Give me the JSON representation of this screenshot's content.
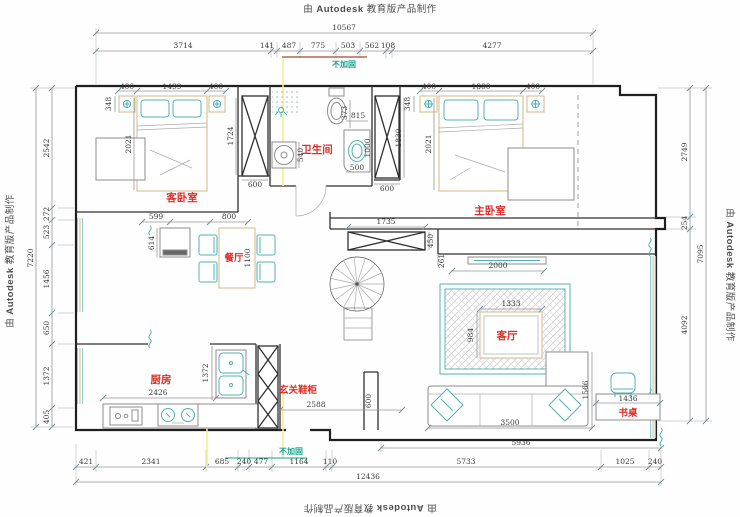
{
  "watermark": {
    "prefix": "由 ",
    "brand": "Autodesk",
    "suffix": " 教育版产品制作"
  },
  "notes": {
    "top": "不加固",
    "bottom": "不加固"
  },
  "rooms": {
    "guest_bedroom": "客卧室",
    "bathroom": "卫生间",
    "master_bedroom": "主卧室",
    "dining_room": "餐厅",
    "kitchen": "厨房",
    "entry_cabinet": "玄关鞋柜",
    "living_room": "客厅",
    "desk": "书桌"
  },
  "dims": {
    "top_total": "10567",
    "top": [
      "3714",
      "141",
      "487",
      "775",
      "503",
      "562",
      "108",
      "4277"
    ],
    "left_total": "7220",
    "left": [
      "2542",
      "272",
      "523",
      "1456",
      "650",
      "1372",
      "405"
    ],
    "right_total": "7095",
    "right": [
      "2749",
      "254",
      "4092"
    ],
    "bottom_total": "12436",
    "bottom": [
      "421",
      "2341",
      "685",
      "240",
      "477",
      "1164",
      "110",
      "5733",
      "1025",
      "240"
    ],
    "sofa_wall": "5936",
    "guest_top": [
      "400",
      "1499",
      "400"
    ],
    "guest_pillow": "348",
    "guest_bed_len": "2021",
    "guest_ward_h": "1724",
    "guest_ward_w": "600",
    "master_top": [
      "400",
      "1800",
      "400"
    ],
    "master_pillow": "348",
    "master_bed_len": "2021",
    "master_ward_h": "1830",
    "master_ward_w": "600",
    "dining_top": [
      "599",
      "800"
    ],
    "dining_cab": "614",
    "dining_table": "1100",
    "bath": {
      "toilet": "373",
      "wall": "815",
      "washer": "540",
      "sink_w": "500",
      "sink_d": "1000"
    },
    "hall": {
      "cabinet": "1735",
      "cabinet_d": "450",
      "tv_gap": "261",
      "stub": "600"
    },
    "living": {
      "tv_wall": "2000",
      "table_w": "1333",
      "table_d": "984",
      "sofa": "3500",
      "desk_off": "1566",
      "desk_w": "1436"
    },
    "kitchen": {
      "counter": "2426",
      "depth": "1372",
      "entry": "2588"
    }
  }
}
